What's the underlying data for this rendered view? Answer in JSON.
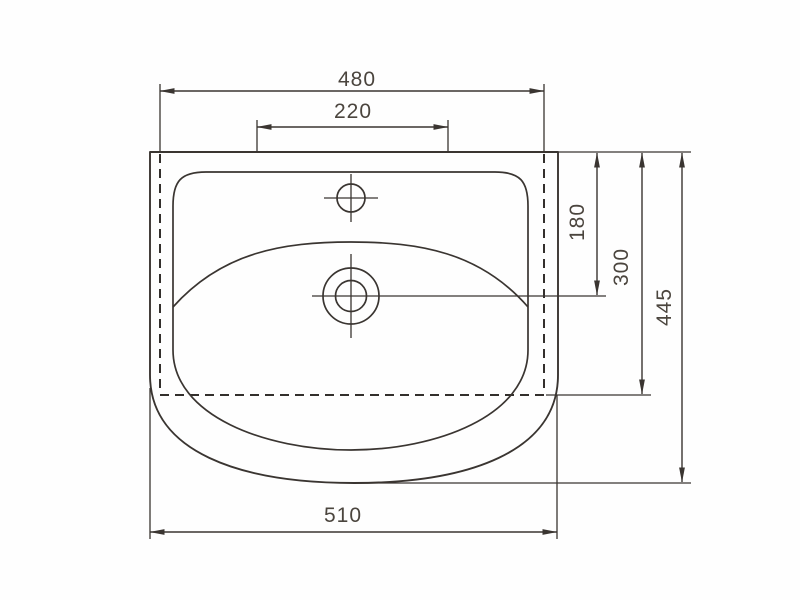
{
  "dims": {
    "top_width": "480",
    "faucet_area_width": "220",
    "rim_to_drain_center": "180",
    "rim_to_mount_line": "300",
    "total_depth": "445",
    "bottom_width": "510"
  },
  "colors": {
    "line": "#3a3531",
    "text": "#4b453e",
    "background": "#fefefe"
  }
}
